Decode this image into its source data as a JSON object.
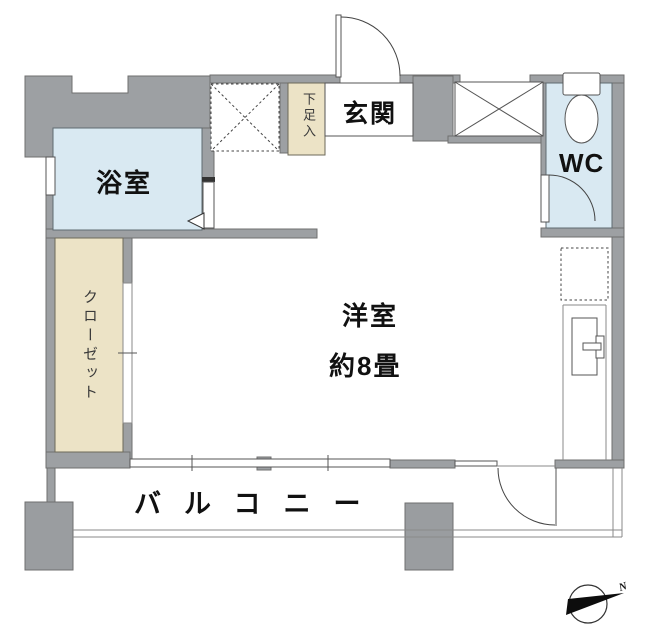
{
  "plan": {
    "bath_label": "浴室",
    "genkan_label": "玄関",
    "shoe_box_label": "下足入",
    "wc_label": "WC",
    "room_label": "洋室",
    "room_size_label": "約8畳",
    "closet_label": "クローゼット",
    "balcony_label": "バルコニー",
    "compass_north": "N"
  },
  "colors": {
    "wall": "#9da0a3",
    "wall_edge": "#6f6f6f",
    "pillar": "#9a9da0",
    "water": "#d9e9f2",
    "storage": "#ece3c6",
    "text": "#111111"
  }
}
